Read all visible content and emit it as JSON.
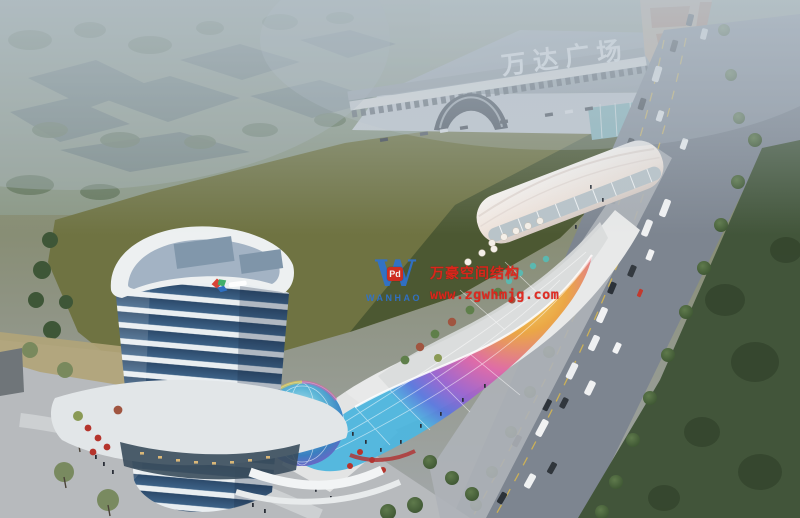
{
  "scene": {
    "title": "aerial-architectural-rendering-mixed-use-commercial-complex",
    "signage": {
      "mall_sign": "万达广场"
    },
    "watermark": {
      "logo_letter": "W",
      "logo_badge": "Pd",
      "logo_name": "WANHAO",
      "line1": "万豪空间结构",
      "line2": "www.zgwhmjg.com"
    },
    "colors": {
      "haze": "#b6c2cc",
      "field_olive": "#6f7342",
      "field_shadow": "#47542f",
      "road_grey": "#7d8590",
      "lawn_dark": "#42553a",
      "tower_glass": "#2c4a6b",
      "tower_band_white": "#e9eef1",
      "podium_white": "#e8e9e9",
      "vault_roof": "#f4ece6",
      "canopy_yellow": "#f2e05a",
      "canopy_orange": "#eba43f",
      "canopy_magenta": "#de66a6",
      "canopy_purple": "#9a63cf",
      "canopy_blue": "#5a78dd",
      "dome_teal": "#5fb8d8",
      "watermark_red": "#e2241a",
      "watermark_blue": "#2e72cf",
      "wanda_wall": "#a7aeb4",
      "tan_building": "#c3ac93",
      "umbrella_red": "#b5342c",
      "umbrella_teal": "#5bb8b0",
      "lane_yellow": "#d9b94e"
    }
  }
}
